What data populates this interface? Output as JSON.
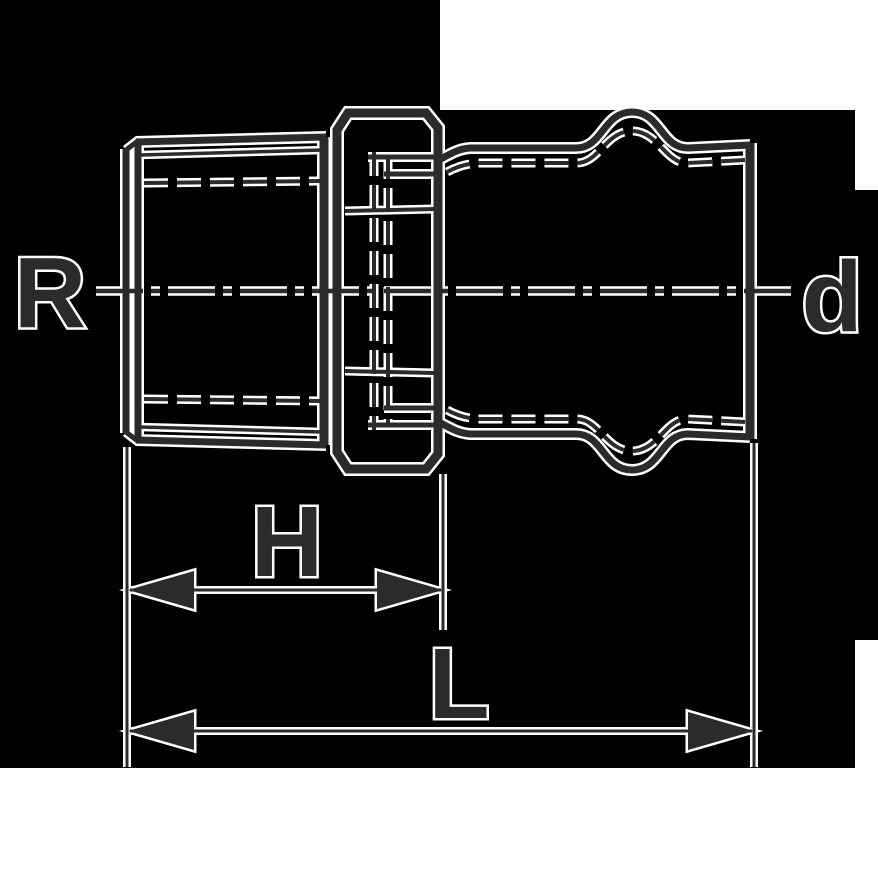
{
  "colors": {
    "line": "#2b2b29",
    "halo": "#ffffff",
    "backdrop": "#000000",
    "canvas": "#ffffff"
  },
  "labels": {
    "thread_size": "R",
    "pipe_diameter": "d",
    "dim_h": "H",
    "dim_l": "L"
  }
}
